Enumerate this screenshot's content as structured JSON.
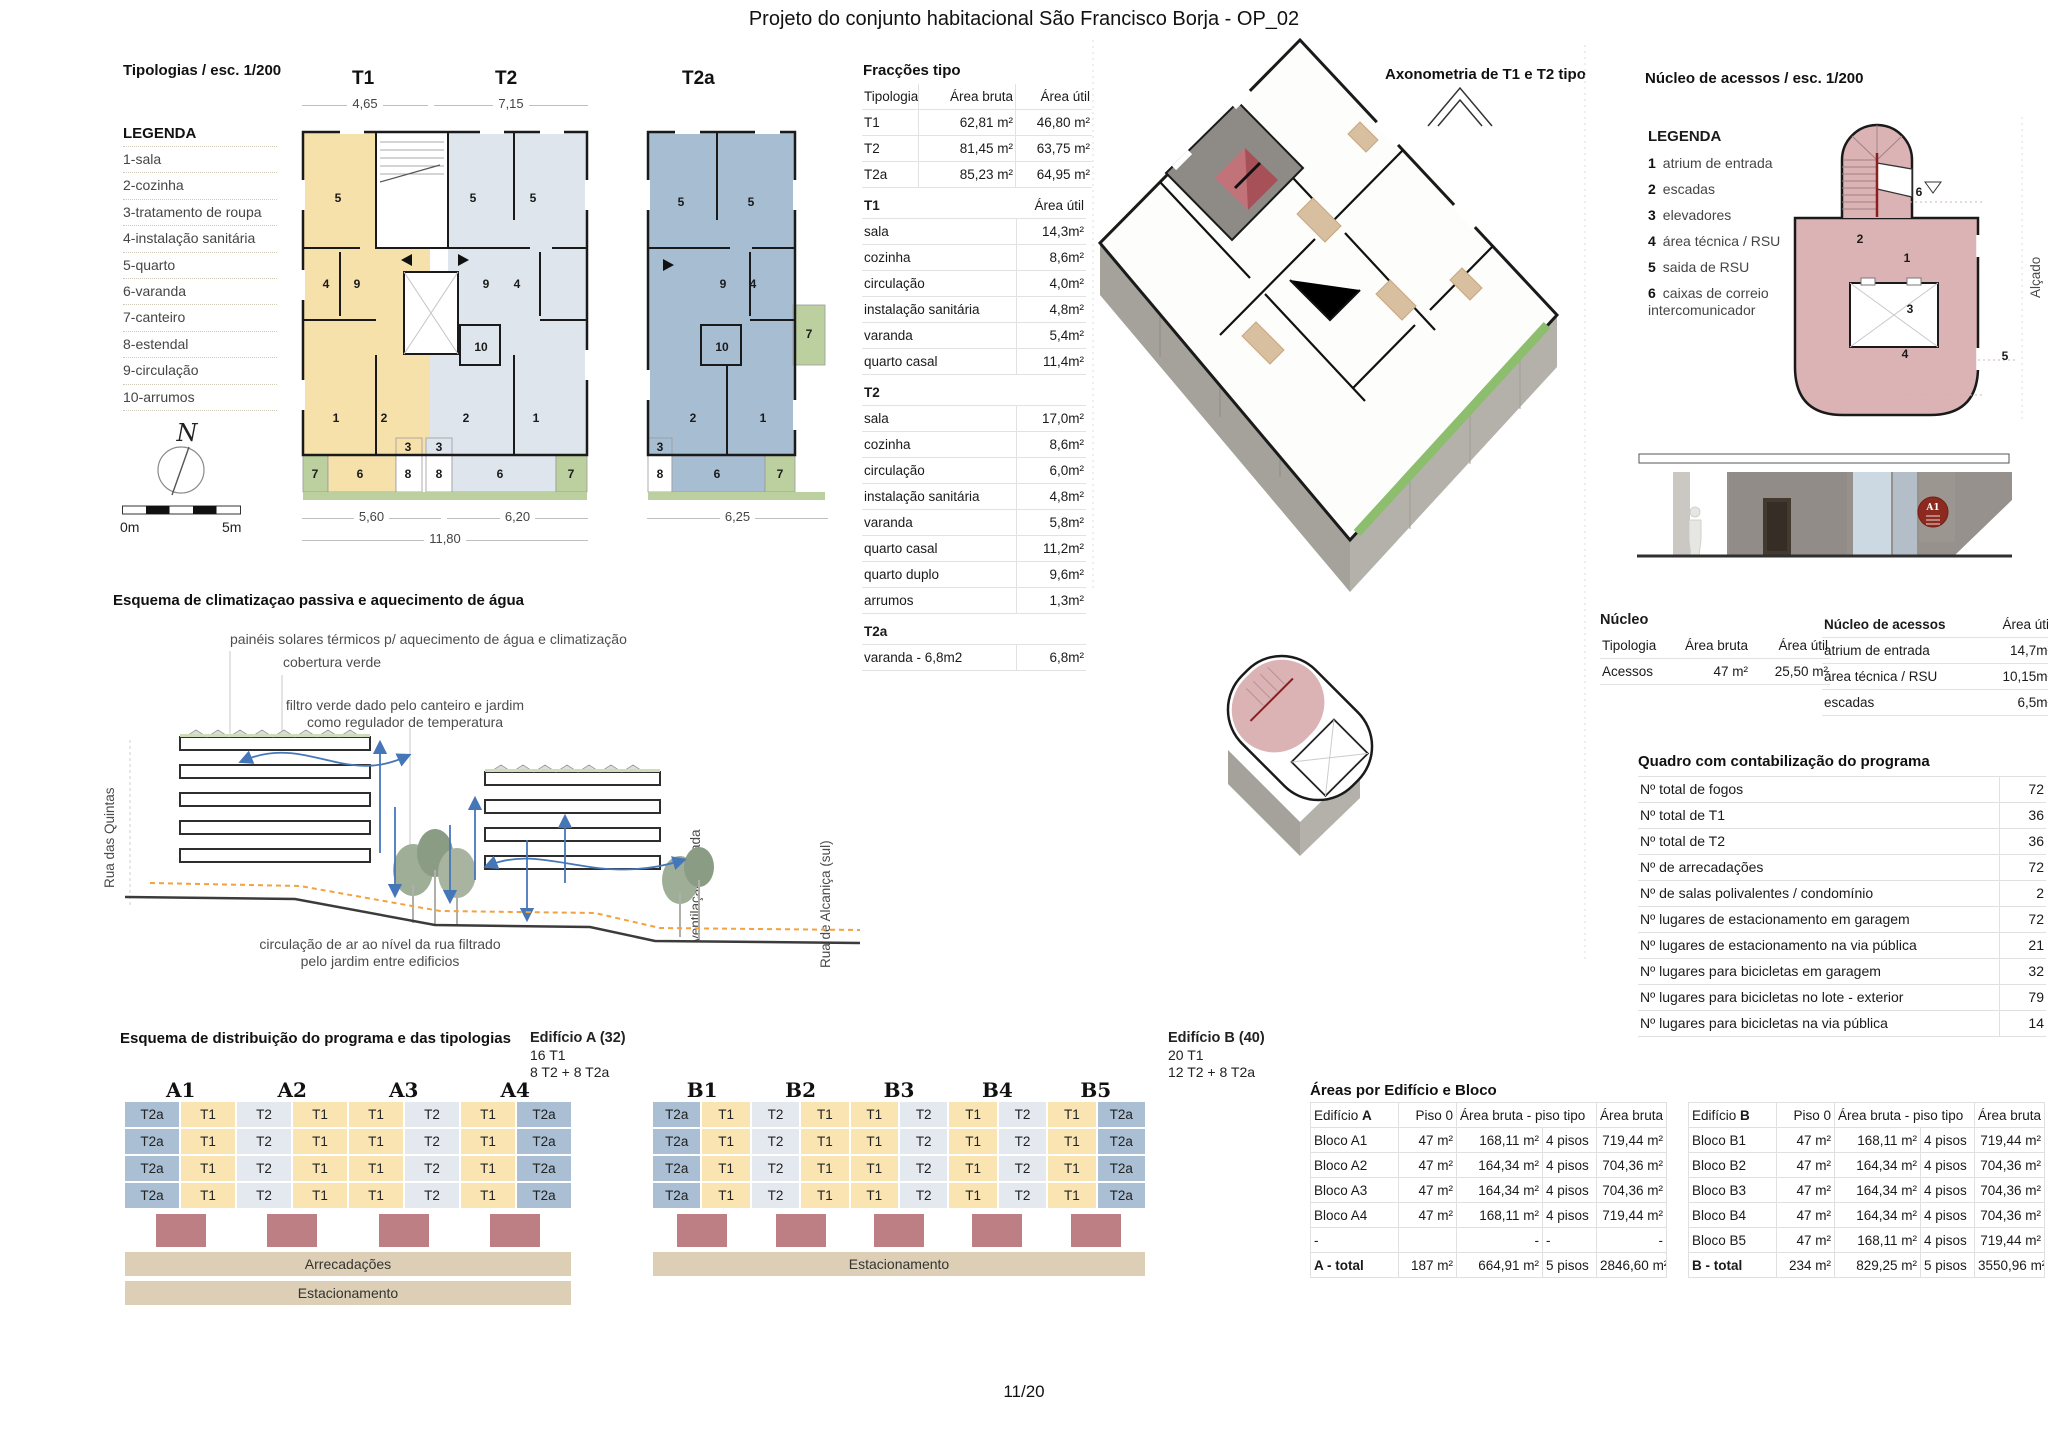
{
  "title": "Projeto do conjunto habitacional São Francisco Borja - OP_02",
  "page_number": "11/20",
  "typologies": {
    "heading": "Tipologias / esc. 1/200",
    "legend_title": "LEGENDA",
    "legend": [
      "1-sala",
      "2-cozinha",
      "3-tratamento de roupa",
      "4-instalação sanitária",
      "5-quarto",
      "6-varanda",
      "7-canteiro",
      "8-estendal",
      "9-circulação",
      "10-arrumos"
    ],
    "compass_label": "N",
    "scale_left": "0m",
    "scale_right": "5m",
    "plan_t1_label": "T1",
    "plan_t2_label": "T2",
    "plan_t2a_label": "T2a",
    "dims": {
      "t1_top": "4,65",
      "t2_top": "7,15",
      "t1_bottom": "5,60",
      "t2_bottom": "6,20",
      "total_bottom": "11,80",
      "t2a_bottom": "6,25"
    },
    "rooms": {
      "t1": [
        "5",
        "4",
        "9",
        "1",
        "2",
        "3",
        "7",
        "6",
        "8"
      ],
      "t2": [
        "5",
        "5",
        "9",
        "4",
        "10",
        "2",
        "1",
        "3",
        "8",
        "6",
        "7"
      ],
      "t2a": [
        "5",
        "5",
        "9",
        "4",
        "10",
        "2",
        "1",
        "3",
        "8",
        "6",
        "7",
        "7"
      ]
    }
  },
  "fraccoes": {
    "title": "Fracções tipo",
    "headers": [
      "Tipologia",
      "Área bruta",
      "Área útil"
    ],
    "rows": [
      [
        "T1",
        "62,81 m²",
        "46,80 m²"
      ],
      [
        "T2",
        "81,45 m²",
        "63,75 m²"
      ],
      [
        "T2a",
        "85,23 m²",
        "64,95 m²"
      ]
    ],
    "sections": [
      {
        "name": "T1",
        "value_header": "Área útil",
        "rows": [
          [
            "sala",
            "14,3m²"
          ],
          [
            "cozinha",
            "8,6m²"
          ],
          [
            "circulação",
            "4,0m²"
          ],
          [
            "instalação sanitária",
            "4,8m²"
          ],
          [
            "varanda",
            "5,4m²"
          ],
          [
            "quarto casal",
            "11,4m²"
          ]
        ]
      },
      {
        "name": "T2",
        "value_header": "",
        "rows": [
          [
            "sala",
            "17,0m²"
          ],
          [
            "cozinha",
            "8,6m²"
          ],
          [
            "circulação",
            "6,0m²"
          ],
          [
            "instalação sanitária",
            "4,8m²"
          ],
          [
            "varanda",
            "5,8m²"
          ],
          [
            "quarto casal",
            "11,2m²"
          ],
          [
            "quarto duplo",
            "9,6m²"
          ],
          [
            "arrumos",
            "1,3m²"
          ]
        ]
      },
      {
        "name": "T2a",
        "value_header": "",
        "rows": [
          [
            "varanda - 6,8m2",
            "6,8m²"
          ]
        ]
      }
    ]
  },
  "axonometria": {
    "title": "Axonometria de T1 e T2 tipo"
  },
  "nucleo": {
    "heading": "Núcleo de acessos / esc. 1/200",
    "legend_title": "LEGENDA",
    "legend": [
      {
        "num": "1",
        "label": "atrium de entrada"
      },
      {
        "num": "2",
        "label": "escadas"
      },
      {
        "num": "3",
        "label": "elevadores"
      },
      {
        "num": "4",
        "label": "área técnica / RSU"
      },
      {
        "num": "5",
        "label": "saida de RSU"
      },
      {
        "num": "6",
        "label": "caixas de correio",
        "label2": "intercomunicador"
      }
    ],
    "plan_labels": [
      "1",
      "2",
      "3",
      "4",
      "5",
      "6"
    ],
    "alcado_label": "Alçado",
    "elevation_badge": "A1",
    "table_nucleo": {
      "title": "Núcleo",
      "headers": [
        "Tipologia",
        "Área bruta",
        "Área útil"
      ],
      "rows": [
        [
          "Acessos",
          "47 m²",
          "25,50 m²"
        ]
      ]
    },
    "table_acessos": {
      "title": "Núcleo de acessos",
      "value_header": "Área útil",
      "rows": [
        [
          "atrium de entrada",
          "14,7m²"
        ],
        [
          "área técnica / RSU",
          "10,15m²"
        ],
        [
          "escadas",
          "6,5m²"
        ]
      ]
    }
  },
  "quadro": {
    "title": "Quadro com contabilização do programa",
    "rows": [
      [
        "Nº total de fogos",
        "72"
      ],
      [
        "Nº total de T1",
        "36"
      ],
      [
        "Nº total de T2",
        "36"
      ],
      [
        "Nº de arrecadações",
        "72"
      ],
      [
        "Nº de salas polivalentes / condomínio",
        "2"
      ],
      [
        "Nº lugares de estacionamento em garagem",
        "72"
      ],
      [
        "Nº lugares de estacionamento na via pública",
        "21"
      ],
      [
        "Nº lugares para bicicletas em garagem",
        "32"
      ],
      [
        "Nº lugares para bicicletas no lote - exterior",
        "79"
      ],
      [
        "Nº lugares para bicicletas na via pública",
        "14"
      ]
    ]
  },
  "climate": {
    "title": "Esquema de climatizaçao passiva e aquecimento de água",
    "ann1": "painéis solares térmicos p/ aquecimento de água e climatização",
    "ann2": "cobertura verde",
    "ann3": "filtro verde dado pelo canteiro e jardim",
    "ann3b": "como regulador de temperatura",
    "ann4": "circulação de ar ao nível da rua filtrado",
    "ann4b": "pelo jardim entre edificios",
    "left_street": "Rua das Quintas",
    "mid_label": "ventilação cruzada",
    "right_street": "Rua de Alcaniça (sul)"
  },
  "distribution": {
    "title": "Esquema de distribuição do programa e das tipologias",
    "building_a": {
      "name": "Edifício A (32)",
      "line2": "16 T1",
      "line3": "8 T2 + 8 T2a",
      "blocks": [
        "A1",
        "A2",
        "A3",
        "A4"
      ],
      "row_pattern": [
        "T2a",
        "T1",
        "T2",
        "T1",
        "T1",
        "T2",
        "T1",
        "T2a"
      ],
      "floors": 4,
      "bars": [
        "Arrecadações",
        "Estacionamento"
      ]
    },
    "building_b": {
      "name": "Edifício B (40)",
      "line2": "20 T1",
      "line3": "12 T2 + 8 T2a",
      "blocks": [
        "B1",
        "B2",
        "B3",
        "B4",
        "B5"
      ],
      "row_pattern": [
        "T2a",
        "T1",
        "T2",
        "T1",
        "T1",
        "T2",
        "T1",
        "T2",
        "T1",
        "T2a"
      ],
      "floors": 4,
      "bars": [
        "Estacionamento"
      ]
    }
  },
  "areas": {
    "title": "Áreas por Edifício e Bloco",
    "table_a": {
      "name_prefix": "Edifício ",
      "letter": "A",
      "col1": "Piso 0",
      "col2": "Área bruta - piso tipo",
      "col3": "Área bruta total",
      "rows": [
        [
          "Bloco A1",
          "47 m²",
          "168,11 m²",
          "4 pisos",
          "719,44 m²"
        ],
        [
          "Bloco A2",
          "47 m²",
          "164,34 m²",
          "4 pisos",
          "704,36 m²"
        ],
        [
          "Bloco A3",
          "47 m²",
          "164,34 m²",
          "4 pisos",
          "704,36 m²"
        ],
        [
          "Bloco A4",
          "47 m²",
          "168,11 m²",
          "4 pisos",
          "719,44 m²"
        ],
        [
          "-",
          "",
          "-",
          "-",
          "-"
        ]
      ],
      "total": [
        "A - total",
        "187 m²",
        "664,91 m²",
        "5 pisos",
        "2846,60 m²"
      ]
    },
    "table_b": {
      "name_prefix": "Edifício ",
      "letter": "B",
      "col1": "Piso 0",
      "col2": "Área bruta - piso tipo",
      "col3": "Área bruta total",
      "rows": [
        [
          "Bloco B1",
          "47 m²",
          "168,11 m²",
          "4 pisos",
          "719,44 m²"
        ],
        [
          "Bloco B2",
          "47 m²",
          "164,34 m²",
          "4 pisos",
          "704,36 m²"
        ],
        [
          "Bloco B3",
          "47 m²",
          "164,34 m²",
          "4 pisos",
          "704,36 m²"
        ],
        [
          "Bloco B4",
          "47 m²",
          "164,34 m²",
          "4 pisos",
          "704,36 m²"
        ],
        [
          "Bloco B5",
          "47 m²",
          "168,11 m²",
          "4 pisos",
          "719,44 m²"
        ]
      ],
      "total": [
        "B - total",
        "234 m²",
        "829,25 m²",
        "5 pisos",
        "3550,96 m²"
      ]
    }
  },
  "colors": {
    "t1_cell": "#fae5b2",
    "t2_cell": "#e4e9f0",
    "t2a_cell": "#aabfd4",
    "t1_plan": "#f7e1ab",
    "t2_plan": "#dfe5ec",
    "t2a_plan": "#a7bdd2",
    "green": "#bccf9e",
    "axon_green": "#8cbe6e",
    "pink": "#dcb3b5",
    "stair_red": "#c2737a",
    "red_block": "#bd7f83",
    "tan_bar": "#ddcfb6",
    "concrete": "#96918c",
    "wood": "#d8bf9f",
    "arrow_blue": "#4577b8",
    "dash_orange": "#f2a23e"
  }
}
